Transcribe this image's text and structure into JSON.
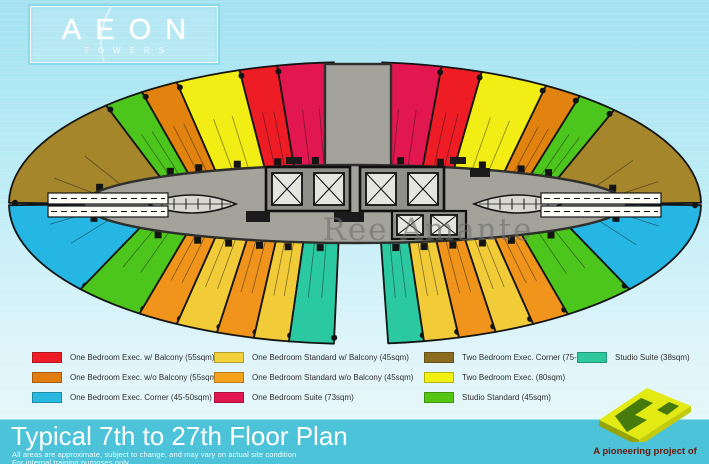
{
  "logo": {
    "title": "AEON",
    "subtitle": "TOWERS"
  },
  "watermark": "Ree Amante",
  "legend": {
    "items": [
      {
        "label": "One Bedroom Exec. w/ Balcony (55sqm)",
        "color": "#ee1c25"
      },
      {
        "label": "One Bedroom Exec. w/o Balcony (55sqm)",
        "color": "#e07c10"
      },
      {
        "label": "One Bedroom Exec. Corner (45-50sqm)",
        "color": "#29b9e0"
      },
      {
        "label": "One Bedroom Standard w/ Balcony (45sqm)",
        "color": "#f2d23c"
      },
      {
        "label": "One Bedroom Standard w/o Balcony (45sqm)",
        "color": "#f5a21c"
      },
      {
        "label": "One Bedroom Suite (73sqm)",
        "color": "#e3174f"
      },
      {
        "label": "Two Bedroom Exec. Corner (75-80)",
        "color": "#8a6b20"
      },
      {
        "label": "Two Bedroom Exec. (80sqm)",
        "color": "#f2ef12"
      },
      {
        "label": "Studio Standard (45sqm)",
        "color": "#55c514"
      },
      {
        "label": "Studio Suite (38sqm)",
        "color": "#2fc89e"
      }
    ]
  },
  "footer": {
    "title": "Typical 7th to 27th Floor Plan",
    "disclaimer1": "All areas are approximate, subject to change, and may vary on actual site condition",
    "disclaimer2": "For internal training purposes only",
    "attribution": "A pioneering project of"
  },
  "plan": {
    "colors": {
      "brown": "#a5862b",
      "green": "#4cc61d",
      "orange_dark": "#e2820f",
      "yellow": "#f2ee15",
      "red": "#ee1c25",
      "crimson": "#e3174f",
      "cyan": "#25b6e3",
      "orange": "#f0941c",
      "gold": "#f2cb38",
      "teal": "#2bc9a1",
      "core": "#a3a39c",
      "core_line": "#2e2e2c",
      "core_light": "#d9d9d2"
    },
    "top_units": [
      {
        "type": "two-bedroom-exec-corner",
        "color": "brown",
        "t0": 180.5,
        "t1": 224
      },
      {
        "type": "studio-standard",
        "color": "green",
        "t0": 224,
        "t1": 232
      },
      {
        "type": "one-bedroom-exec-wo-balcony",
        "color": "orange_dark",
        "t0": 232,
        "t1": 239
      },
      {
        "type": "two-bedroom-exec",
        "color": "yellow",
        "t0": 239,
        "t1": 250.5
      },
      {
        "type": "one-bedroom-exec-w-balcony",
        "color": "red",
        "t0": 250.5,
        "t1": 257
      },
      {
        "type": "one-bedroom-suite",
        "color": "crimson",
        "t0": 257,
        "t1": 266.5
      },
      {
        "type": "one-bedroom-suite",
        "color": "crimson",
        "t0": 274.5,
        "t1": 284.5
      },
      {
        "type": "one-bedroom-exec-w-balcony",
        "color": "red",
        "t0": 284.5,
        "t1": 291.5
      },
      {
        "type": "two-bedroom-exec",
        "color": "yellow",
        "t0": 291.5,
        "t1": 303.5
      },
      {
        "type": "one-bedroom-exec-wo-balcony",
        "color": "orange_dark",
        "t0": 303.5,
        "t1": 310.5
      },
      {
        "type": "studio-standard",
        "color": "green",
        "t0": 310.5,
        "t1": 318.5
      },
      {
        "type": "two-bedroom-exec-corner",
        "color": "brown",
        "t0": 318.5,
        "t1": 359.5
      }
    ],
    "bottom_units": [
      {
        "type": "one-bedroom-exec-corner",
        "color": "cyan",
        "t0": 142.5,
        "t1": 179.5
      },
      {
        "type": "studio-standard",
        "color": "green",
        "t0": 128.5,
        "t1": 142.5
      },
      {
        "type": "one-bedroom-standard-wo-balcony",
        "color": "orange",
        "t0": 121,
        "t1": 128.5
      },
      {
        "type": "one-bedroom-standard-w-balcony",
        "color": "gold",
        "t0": 113.5,
        "t1": 121
      },
      {
        "type": "one-bedroom-standard-wo-balcony",
        "color": "orange",
        "t0": 107,
        "t1": 113.5
      },
      {
        "type": "one-bedroom-standard-w-balcony",
        "color": "gold",
        "t0": 101,
        "t1": 107
      },
      {
        "type": "studio-suite",
        "color": "teal",
        "t0": 93.5,
        "t1": 101
      },
      {
        "type": "studio-suite",
        "color": "teal",
        "t0": 78.5,
        "t1": 84.5
      },
      {
        "type": "one-bedroom-standard-w-balcony",
        "color": "gold",
        "t0": 72.5,
        "t1": 78.5
      },
      {
        "type": "one-bedroom-standard-wo-balcony",
        "color": "orange",
        "t0": 66,
        "t1": 72.5
      },
      {
        "type": "one-bedroom-standard-w-balcony",
        "color": "gold",
        "t0": 59,
        "t1": 66
      },
      {
        "type": "one-bedroom-standard-wo-balcony",
        "color": "orange",
        "t0": 52,
        "t1": 59
      },
      {
        "type": "studio-standard",
        "color": "green",
        "t0": 37.5,
        "t1": 52
      },
      {
        "type": "one-bedroom-exec-corner",
        "color": "cyan",
        "t0": 0.5,
        "t1": 37.5
      }
    ]
  }
}
